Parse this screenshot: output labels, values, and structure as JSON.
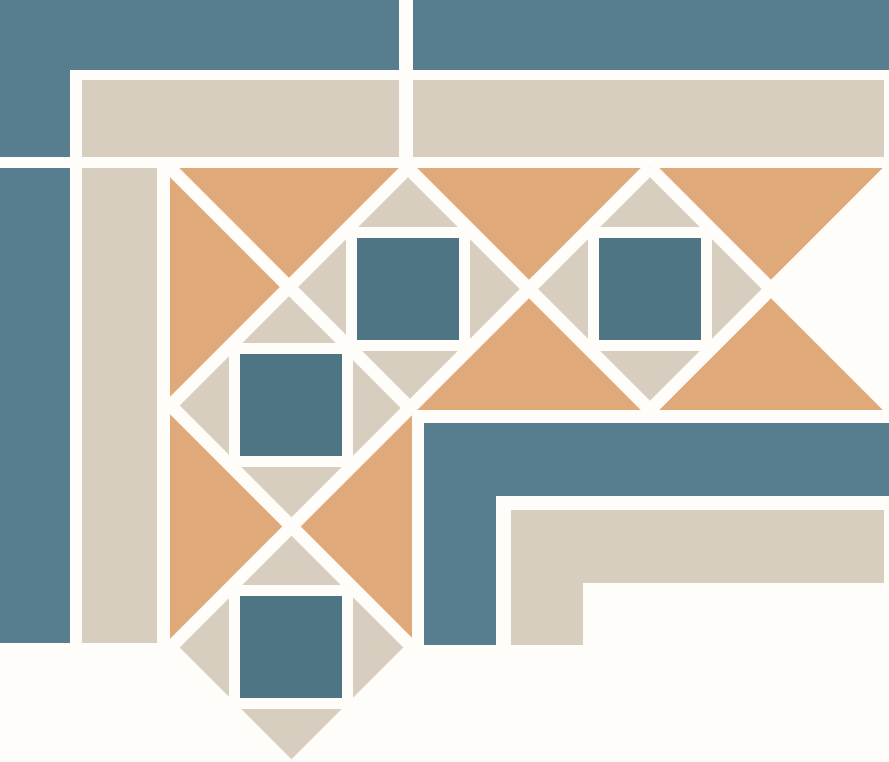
{
  "canvas": {
    "width": 889,
    "height": 762
  },
  "palette": {
    "background": "#FFFDF9",
    "teal": "#567E8E",
    "teal_square": "#4D7584",
    "cream": "#D7CEBF",
    "terracotta": "#E0A97A"
  },
  "grout": {
    "width": 13
  },
  "shapes": [
    {
      "type": "rect",
      "name": "background-field",
      "color": "background",
      "x": 0,
      "y": 0,
      "w": 889,
      "h": 762
    },
    {
      "type": "rect",
      "name": "teal-outer-band-top-left",
      "color": "teal",
      "x": 0,
      "y": 0,
      "w": 399,
      "h": 70
    },
    {
      "type": "rect",
      "name": "teal-outer-corner-tile",
      "color": "teal",
      "x": 0,
      "y": 0,
      "w": 70,
      "h": 157
    },
    {
      "type": "rect",
      "name": "teal-outer-band-top-right",
      "color": "teal",
      "x": 413,
      "y": 0,
      "w": 476,
      "h": 70
    },
    {
      "type": "rect",
      "name": "cream-outer-band-top-left",
      "color": "cream",
      "x": 82,
      "y": 80,
      "w": 317,
      "h": 77
    },
    {
      "type": "rect",
      "name": "cream-outer-band-top-right",
      "color": "cream",
      "x": 413,
      "y": 80,
      "w": 471,
      "h": 77
    },
    {
      "type": "rect",
      "name": "teal-outer-strip-left",
      "color": "teal",
      "x": 0,
      "y": 168,
      "w": 70,
      "h": 475
    },
    {
      "type": "rect",
      "name": "cream-outer-strip-left",
      "color": "cream",
      "x": 82,
      "y": 168,
      "w": 75,
      "h": 475
    },
    {
      "type": "rect",
      "name": "terracotta-border-band-top",
      "color": "terracotta",
      "x": 170,
      "y": 168,
      "w": 714,
      "h": 242
    },
    {
      "type": "rect",
      "name": "terracotta-border-band-left",
      "color": "terracotta",
      "x": 170,
      "y": 168,
      "w": 242,
      "h": 480
    },
    {
      "type": "polygon",
      "name": "band-right-end-cap",
      "color": "background",
      "points": "897,158 771,289 897,420"
    },
    {
      "type": "polygon",
      "name": "diamond-motif-top-1",
      "color": "cream",
      "points": "408,167 530,289 408,411 286,289"
    },
    {
      "type": "polygon",
      "name": "diamond-motif-top-2",
      "color": "cream",
      "points": "650,167 772,289 650,411 528,289"
    },
    {
      "type": "polygon",
      "name": "diamond-motif-left-1",
      "color": "cream",
      "points": "291,283 413,405 291,527 169,405"
    },
    {
      "type": "polygon",
      "name": "diamond-motif-left-2",
      "color": "cream",
      "points": "291,525 413,647 291,769 169,647"
    },
    {
      "type": "rect",
      "name": "grout-ring-top-1",
      "color": "background",
      "x": 346,
      "y": 227,
      "w": 124,
      "h": 124
    },
    {
      "type": "rect",
      "name": "grout-ring-top-2",
      "color": "background",
      "x": 588,
      "y": 227,
      "w": 124,
      "h": 124
    },
    {
      "type": "rect",
      "name": "grout-ring-left-1",
      "color": "background",
      "x": 229,
      "y": 343,
      "w": 124,
      "h": 124
    },
    {
      "type": "rect",
      "name": "grout-ring-left-2",
      "color": "background",
      "x": 229,
      "y": 585,
      "w": 124,
      "h": 124
    },
    {
      "type": "rect",
      "name": "teal-inset-square-top-1",
      "color": "teal_square",
      "x": 357,
      "y": 238,
      "w": 102,
      "h": 102
    },
    {
      "type": "rect",
      "name": "teal-inset-square-top-2",
      "color": "teal_square",
      "x": 599,
      "y": 238,
      "w": 102,
      "h": 102
    },
    {
      "type": "rect",
      "name": "teal-inset-square-left-1",
      "color": "teal_square",
      "x": 240,
      "y": 354,
      "w": 102,
      "h": 102
    },
    {
      "type": "rect",
      "name": "teal-inset-square-left-2",
      "color": "teal_square",
      "x": 240,
      "y": 596,
      "w": 102,
      "h": 102
    },
    {
      "type": "line",
      "name": "grout-diagonal-ne-sw-1",
      "color": "background",
      "x1": 408,
      "y1": 168,
      "x2": 170,
      "y2": 406
    },
    {
      "type": "line",
      "name": "grout-diagonal-ne-sw-2",
      "color": "background",
      "x1": 650,
      "y1": 168,
      "x2": 170,
      "y2": 648
    },
    {
      "type": "line",
      "name": "grout-diagonal-ne-sw-3",
      "color": "background",
      "x1": 895,
      "y1": 165,
      "x2": 650,
      "y2": 410
    },
    {
      "type": "line",
      "name": "grout-diagonal-ne-sw-4",
      "color": "background",
      "x1": 413,
      "y1": 647,
      "x2": 291,
      "y2": 769
    },
    {
      "type": "line",
      "name": "grout-diagonal-miter",
      "color": "background",
      "x1": 170,
      "y1": 168,
      "x2": 412,
      "y2": 410
    },
    {
      "type": "line",
      "name": "grout-diagonal-nw-se-2",
      "color": "background",
      "x1": 650,
      "y1": 168,
      "x2": 889,
      "y2": 407
    },
    {
      "type": "line",
      "name": "grout-diagonal-nw-se-3",
      "color": "background",
      "x1": 408,
      "y1": 168,
      "x2": 650,
      "y2": 410
    },
    {
      "type": "line",
      "name": "grout-diagonal-nw-se-4",
      "color": "background",
      "x1": 170,
      "y1": 405,
      "x2": 413,
      "y2": 648
    },
    {
      "type": "line",
      "name": "grout-diagonal-nw-se-5",
      "color": "background",
      "x1": 170,
      "y1": 647,
      "x2": 291,
      "y2": 768
    },
    {
      "type": "rect",
      "name": "grout-vertical-top-seam",
      "color": "background",
      "x": 399,
      "y": 0,
      "w": 14,
      "h": 168
    },
    {
      "type": "rect",
      "name": "teal-inner-band-horizontal",
      "color": "teal",
      "x": 424,
      "y": 423,
      "w": 465,
      "h": 73
    },
    {
      "type": "rect",
      "name": "teal-inner-band-vertical",
      "color": "teal",
      "x": 424,
      "y": 423,
      "w": 72,
      "h": 222
    },
    {
      "type": "rect",
      "name": "cream-inner-band-horizontal",
      "color": "cream",
      "x": 511,
      "y": 510,
      "w": 373,
      "h": 73
    },
    {
      "type": "rect",
      "name": "cream-inner-band-vertical",
      "color": "cream",
      "x": 511,
      "y": 510,
      "w": 72,
      "h": 135
    }
  ]
}
